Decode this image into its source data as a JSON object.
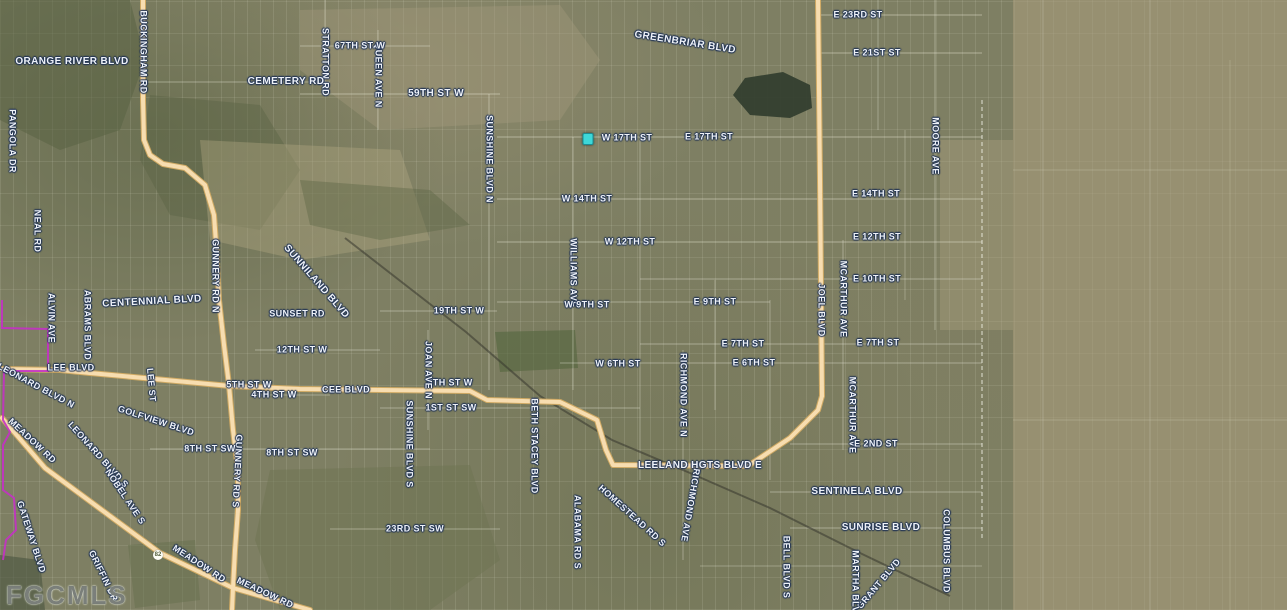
{
  "watermark": "FGCMLS",
  "marker": {
    "x": 588,
    "y": 139,
    "color": "#3ed8d8",
    "border": "#1b8f96"
  },
  "shield": {
    "x": 158,
    "y": 555,
    "label": "82"
  },
  "colors": {
    "base": "#7e7f63",
    "highway_core": "#f7ddb0",
    "highway_casing": "#cfa963",
    "boundary": "#c431c4",
    "railroad": "rgba(55,55,45,0.55)",
    "minor_road": "rgba(238,238,222,0.55)",
    "label_text": "#eef2f8",
    "label_halo": "#223455",
    "water_dark": "#343f2f"
  },
  "labels": [
    {
      "t": "ORANGE RIVER BLVD",
      "x": 72,
      "y": 62,
      "r": 0,
      "s": 10
    },
    {
      "t": "BUCKINGHAM RD",
      "x": 143,
      "y": 52,
      "r": 90,
      "s": 9
    },
    {
      "t": "STRATTON RD",
      "x": 325,
      "y": 62,
      "r": 90,
      "s": 9
    },
    {
      "t": "QUEEN AVE N",
      "x": 378,
      "y": 75,
      "r": 90,
      "s": 9
    },
    {
      "t": "67TH ST W",
      "x": 360,
      "y": 46,
      "r": 0,
      "s": 9
    },
    {
      "t": "CEMETERY RD",
      "x": 286,
      "y": 82,
      "r": 0,
      "s": 10
    },
    {
      "t": "59TH ST W",
      "x": 436,
      "y": 94,
      "r": 0,
      "s": 10
    },
    {
      "t": "GREENBRIAR BLVD",
      "x": 685,
      "y": 43,
      "r": 9,
      "s": 10
    },
    {
      "t": "E 23RD ST",
      "x": 858,
      "y": 15,
      "r": 0,
      "s": 9
    },
    {
      "t": "E 21ST ST",
      "x": 877,
      "y": 53,
      "r": 0,
      "s": 9
    },
    {
      "t": "PANGOLA DR",
      "x": 12,
      "y": 141,
      "r": 90,
      "s": 9
    },
    {
      "t": "NEAL RD",
      "x": 37,
      "y": 231,
      "r": 90,
      "s": 9
    },
    {
      "t": "W 17TH ST",
      "x": 627,
      "y": 138,
      "r": 0,
      "s": 9
    },
    {
      "t": "E 17TH ST",
      "x": 709,
      "y": 137,
      "r": 0,
      "s": 9
    },
    {
      "t": "SUNSHINE BLVD N",
      "x": 489,
      "y": 159,
      "r": 90,
      "s": 9
    },
    {
      "t": "MOORE AVE",
      "x": 935,
      "y": 146,
      "r": 90,
      "s": 9
    },
    {
      "t": "W 14TH ST",
      "x": 587,
      "y": 199,
      "r": 0,
      "s": 9
    },
    {
      "t": "E 14TH ST",
      "x": 876,
      "y": 194,
      "r": 0,
      "s": 9
    },
    {
      "t": "W 12TH ST",
      "x": 630,
      "y": 242,
      "r": 0,
      "s": 9
    },
    {
      "t": "E 12TH ST",
      "x": 877,
      "y": 237,
      "r": 0,
      "s": 9
    },
    {
      "t": "E 10TH ST",
      "x": 877,
      "y": 279,
      "r": 0,
      "s": 9
    },
    {
      "t": "WILLIAMS AVE",
      "x": 573,
      "y": 273,
      "r": 90,
      "s": 9
    },
    {
      "t": "W 9TH ST",
      "x": 587,
      "y": 305,
      "r": 0,
      "s": 9
    },
    {
      "t": "E 9TH ST",
      "x": 715,
      "y": 302,
      "r": 0,
      "s": 9
    },
    {
      "t": "E 7TH ST",
      "x": 743,
      "y": 344,
      "r": 0,
      "s": 9
    },
    {
      "t": "E 7TH ST",
      "x": 878,
      "y": 343,
      "r": 0,
      "s": 9
    },
    {
      "t": "W 6TH ST",
      "x": 618,
      "y": 364,
      "r": 0,
      "s": 9
    },
    {
      "t": "E 6TH ST",
      "x": 754,
      "y": 363,
      "r": 0,
      "s": 9
    },
    {
      "t": "MCARTHUR AVE",
      "x": 843,
      "y": 299,
      "r": 90,
      "s": 9
    },
    {
      "t": "MCARTHUR AVE",
      "x": 852,
      "y": 415,
      "r": 90,
      "s": 9
    },
    {
      "t": "JOEL BLVD",
      "x": 821,
      "y": 310,
      "r": 90,
      "s": 9
    },
    {
      "t": "GUNNERY RD N",
      "x": 215,
      "y": 276,
      "r": 90,
      "s": 9
    },
    {
      "t": "GUNNERY RD S",
      "x": 237,
      "y": 471,
      "r": 93,
      "s": 9
    },
    {
      "t": "CENTENNIAL BLVD",
      "x": 152,
      "y": 302,
      "r": -3,
      "s": 10
    },
    {
      "t": "SUNNILAND BLVD",
      "x": 316,
      "y": 282,
      "r": 49,
      "s": 10
    },
    {
      "t": "SUNSET RD",
      "x": 297,
      "y": 314,
      "r": 0,
      "s": 9
    },
    {
      "t": "19TH ST W",
      "x": 459,
      "y": 311,
      "r": 0,
      "s": 9
    },
    {
      "t": "ALVIN AVE",
      "x": 51,
      "y": 318,
      "r": 90,
      "s": 9
    },
    {
      "t": "ABRAMS BLVD",
      "x": 87,
      "y": 325,
      "r": 90,
      "s": 9
    },
    {
      "t": "12TH ST W",
      "x": 302,
      "y": 350,
      "r": 0,
      "s": 9
    },
    {
      "t": "LEE BLVD",
      "x": 71,
      "y": 368,
      "r": 0,
      "s": 9
    },
    {
      "t": "LEE ST",
      "x": 151,
      "y": 385,
      "r": 85,
      "s": 9
    },
    {
      "t": "LEONARD BLVD N",
      "x": 36,
      "y": 386,
      "r": 28,
      "s": 9
    },
    {
      "t": "5TH ST W",
      "x": 249,
      "y": 385,
      "r": 0,
      "s": 9
    },
    {
      "t": "4TH ST W",
      "x": 274,
      "y": 395,
      "r": 0,
      "s": 9
    },
    {
      "t": "CEE BLVD",
      "x": 346,
      "y": 390,
      "r": 0,
      "s": 9
    },
    {
      "t": "5TH ST W",
      "x": 450,
      "y": 383,
      "r": 0,
      "s": 9
    },
    {
      "t": "1ST ST SW",
      "x": 451,
      "y": 408,
      "r": 0,
      "s": 9
    },
    {
      "t": "JOAN AVE N",
      "x": 428,
      "y": 370,
      "r": 90,
      "s": 9
    },
    {
      "t": "RICHMOND AVE N",
      "x": 683,
      "y": 395,
      "r": 90,
      "s": 9
    },
    {
      "t": "RICHMOND AVE",
      "x": 690,
      "y": 505,
      "r": 100,
      "s": 9
    },
    {
      "t": "GOLFVIEW BLVD",
      "x": 156,
      "y": 421,
      "r": 18,
      "s": 9
    },
    {
      "t": "MEADOW RD",
      "x": 32,
      "y": 441,
      "r": 43,
      "s": 9
    },
    {
      "t": "LEONARD BLVD S",
      "x": 98,
      "y": 455,
      "r": 48,
      "s": 9
    },
    {
      "t": "8TH ST SW",
      "x": 210,
      "y": 449,
      "r": 0,
      "s": 9
    },
    {
      "t": "8TH ST SW",
      "x": 292,
      "y": 453,
      "r": 0,
      "s": 9
    },
    {
      "t": "SUNSHINE BLVD S",
      "x": 409,
      "y": 444,
      "r": 90,
      "s": 9
    },
    {
      "t": "BETH STACEY BLVD",
      "x": 534,
      "y": 446,
      "r": 90,
      "s": 9
    },
    {
      "t": "LEELAND HGTS BLVD E",
      "x": 700,
      "y": 466,
      "r": 0,
      "s": 10
    },
    {
      "t": "E 2ND ST",
      "x": 876,
      "y": 444,
      "r": 0,
      "s": 9
    },
    {
      "t": "NOBEL AVE S",
      "x": 125,
      "y": 497,
      "r": 56,
      "s": 9
    },
    {
      "t": "GATEWAY BLVD",
      "x": 31,
      "y": 537,
      "r": 72,
      "s": 9
    },
    {
      "t": "GRIFFIN DR",
      "x": 103,
      "y": 576,
      "r": 64,
      "s": 9
    },
    {
      "t": "SENTINELA BLVD",
      "x": 857,
      "y": 492,
      "r": 0,
      "s": 10
    },
    {
      "t": "SUNRISE BLVD",
      "x": 881,
      "y": 528,
      "r": 0,
      "s": 10
    },
    {
      "t": "23RD ST SW",
      "x": 415,
      "y": 529,
      "r": 0,
      "s": 9
    },
    {
      "t": "ALABAMA RD S",
      "x": 577,
      "y": 532,
      "r": 90,
      "s": 9
    },
    {
      "t": "HOMESTEAD RD S",
      "x": 632,
      "y": 516,
      "r": 42,
      "s": 9
    },
    {
      "t": "BELL BLVD S",
      "x": 786,
      "y": 567,
      "r": 90,
      "s": 9
    },
    {
      "t": "COLUMBUS BLVD",
      "x": 946,
      "y": 551,
      "r": 90,
      "s": 9
    },
    {
      "t": "GRANT BLVD",
      "x": 879,
      "y": 584,
      "r": -50,
      "s": 9
    },
    {
      "t": "MARTHA BLVD",
      "x": 855,
      "y": 585,
      "r": 90,
      "s": 9
    },
    {
      "t": "MEADOW RD",
      "x": 199,
      "y": 564,
      "r": 33,
      "s": 9
    },
    {
      "t": "MEADOW RD",
      "x": 265,
      "y": 593,
      "r": 25,
      "s": 9
    }
  ],
  "highways": [
    {
      "name": "buckingham-gunnery-rd",
      "pts": [
        [
          143,
          0
        ],
        [
          143,
          100
        ],
        [
          144,
          140
        ],
        [
          150,
          155
        ],
        [
          163,
          164
        ],
        [
          185,
          168
        ],
        [
          205,
          185
        ],
        [
          214,
          215
        ],
        [
          216,
          243
        ],
        [
          219,
          300
        ],
        [
          224,
          345
        ],
        [
          229,
          385
        ],
        [
          233,
          430
        ],
        [
          238,
          470
        ],
        [
          238,
          510
        ],
        [
          235,
          550
        ],
        [
          233,
          588
        ],
        [
          232,
          610
        ]
      ]
    },
    {
      "name": "lee-blvd-cee-blvd-leeland-hgts",
      "pts": [
        [
          0,
          369
        ],
        [
          60,
          370
        ],
        [
          90,
          373
        ],
        [
          230,
          386
        ],
        [
          300,
          389
        ],
        [
          470,
          391
        ],
        [
          487,
          400
        ],
        [
          560,
          402
        ],
        [
          597,
          420
        ],
        [
          606,
          450
        ],
        [
          613,
          465
        ],
        [
          748,
          466
        ],
        [
          790,
          438
        ],
        [
          818,
          410
        ],
        [
          822,
          396
        ]
      ]
    },
    {
      "name": "joel-blvd",
      "pts": [
        [
          818,
          0
        ],
        [
          820,
          180
        ],
        [
          822,
          396
        ]
      ]
    },
    {
      "name": "meadow-rd",
      "pts": [
        [
          2,
          418
        ],
        [
          45,
          468
        ],
        [
          160,
          553
        ],
        [
          233,
          588
        ],
        [
          310,
          610
        ]
      ]
    }
  ],
  "railroad": {
    "pts": [
      [
        345,
        238
      ],
      [
        466,
        332
      ],
      [
        540,
        396
      ],
      [
        612,
        440
      ],
      [
        690,
        473
      ],
      [
        770,
        508
      ],
      [
        860,
        553
      ],
      [
        950,
        596
      ]
    ]
  },
  "boundary": {
    "pts": [
      [
        2,
        300
      ],
      [
        2,
        328
      ],
      [
        48,
        329
      ],
      [
        48,
        371
      ],
      [
        4,
        371
      ],
      [
        3,
        420
      ],
      [
        10,
        432
      ],
      [
        3,
        445
      ],
      [
        3,
        490
      ],
      [
        14,
        498
      ],
      [
        16,
        530
      ],
      [
        6,
        540
      ],
      [
        3,
        560
      ]
    ]
  },
  "terrain": [
    {
      "fill": "#5a6344",
      "op": 0.55,
      "pts": [
        [
          0,
          0
        ],
        [
          130,
          0
        ],
        [
          145,
          60
        ],
        [
          120,
          130
        ],
        [
          60,
          150
        ],
        [
          0,
          120
        ]
      ]
    },
    {
      "fill": "#5a6344",
      "op": 0.45,
      "pts": [
        [
          150,
          95
        ],
        [
          260,
          105
        ],
        [
          300,
          170
        ],
        [
          260,
          230
        ],
        [
          170,
          215
        ],
        [
          140,
          160
        ]
      ]
    },
    {
      "fill": "#b2a783",
      "op": 0.4,
      "pts": [
        [
          200,
          140
        ],
        [
          400,
          150
        ],
        [
          430,
          240
        ],
        [
          300,
          260
        ],
        [
          210,
          240
        ]
      ]
    },
    {
      "fill": "#5a6344",
      "op": 0.4,
      "pts": [
        [
          300,
          180
        ],
        [
          430,
          190
        ],
        [
          470,
          225
        ],
        [
          380,
          240
        ],
        [
          310,
          225
        ]
      ]
    },
    {
      "fill": "#a99f80",
      "op": 0.35,
      "pts": [
        [
          300,
          10
        ],
        [
          560,
          5
        ],
        [
          600,
          60
        ],
        [
          560,
          120
        ],
        [
          380,
          130
        ],
        [
          300,
          70
        ]
      ]
    },
    {
      "fill": "#b2a783",
      "op": 0.35,
      "pts": [
        [
          940,
          140
        ],
        [
          1013,
          140
        ],
        [
          1013,
          330
        ],
        [
          940,
          330
        ]
      ]
    },
    {
      "fill": "#ab9f7d",
      "op": 0.55,
      "pts": [
        [
          1013,
          0
        ],
        [
          1287,
          0
        ],
        [
          1287,
          610
        ],
        [
          1013,
          610
        ]
      ]
    },
    {
      "fill": "#53653e",
      "op": 0.6,
      "pts": [
        [
          495,
          332
        ],
        [
          575,
          330
        ],
        [
          578,
          368
        ],
        [
          500,
          372
        ]
      ]
    },
    {
      "fill": "#6d7352",
      "op": 0.5,
      "pts": [
        [
          270,
          470
        ],
        [
          470,
          465
        ],
        [
          500,
          560
        ],
        [
          430,
          610
        ],
        [
          280,
          610
        ],
        [
          255,
          540
        ]
      ]
    },
    {
      "fill": "#66704e",
      "op": 0.5,
      "pts": [
        [
          128,
          545
        ],
        [
          195,
          540
        ],
        [
          200,
          600
        ],
        [
          135,
          608
        ]
      ]
    },
    {
      "fill": "#4a5440",
      "op": 0.6,
      "pts": [
        [
          0,
          555
        ],
        [
          40,
          560
        ],
        [
          45,
          610
        ],
        [
          0,
          610
        ]
      ]
    },
    {
      "fill": "#343f2f",
      "op": 0.95,
      "pts": [
        [
          733,
          95
        ],
        [
          745,
          78
        ],
        [
          783,
          72
        ],
        [
          810,
          85
        ],
        [
          812,
          108
        ],
        [
          790,
          118
        ],
        [
          750,
          115
        ]
      ]
    }
  ],
  "minor_roads": [
    [
      820,
      15,
      982,
      15,
      0.55
    ],
    [
      820,
      53,
      982,
      53,
      0.55
    ],
    [
      300,
      46,
      430,
      46,
      0.5
    ],
    [
      140,
      82,
      330,
      82,
      0.5
    ],
    [
      300,
      94,
      500,
      94,
      0.55
    ],
    [
      497,
      137,
      982,
      137,
      0.55
    ],
    [
      497,
      199,
      982,
      199,
      0.55
    ],
    [
      497,
      242,
      982,
      242,
      0.55
    ],
    [
      640,
      279,
      982,
      279,
      0.5
    ],
    [
      497,
      302,
      770,
      302,
      0.5
    ],
    [
      380,
      311,
      497,
      311,
      0.5
    ],
    [
      640,
      344,
      982,
      344,
      0.5
    ],
    [
      560,
      363,
      982,
      363,
      0.5
    ],
    [
      255,
      350,
      380,
      350,
      0.5
    ],
    [
      255,
      395,
      330,
      395,
      0.45
    ],
    [
      380,
      408,
      640,
      408,
      0.5
    ],
    [
      150,
      449,
      430,
      449,
      0.5
    ],
    [
      790,
      444,
      982,
      444,
      0.5
    ],
    [
      770,
      492,
      982,
      492,
      0.5
    ],
    [
      790,
      528,
      982,
      528,
      0.5
    ],
    [
      330,
      529,
      500,
      529,
      0.5
    ],
    [
      700,
      566,
      982,
      566,
      0.4
    ],
    [
      325,
      0,
      325,
      94,
      0.5
    ],
    [
      378,
      30,
      378,
      130,
      0.5
    ],
    [
      428,
      330,
      428,
      430,
      0.5
    ],
    [
      489,
      94,
      489,
      390,
      0.55
    ],
    [
      573,
      137,
      573,
      390,
      0.5
    ],
    [
      640,
      137,
      640,
      480,
      0.45
    ],
    [
      683,
      350,
      683,
      560,
      0.5
    ],
    [
      715,
      280,
      715,
      410,
      0.45
    ],
    [
      770,
      300,
      770,
      480,
      0.45
    ],
    [
      843,
      240,
      843,
      450,
      0.5
    ],
    [
      878,
      0,
      878,
      130,
      0.45
    ],
    [
      905,
      130,
      905,
      300,
      0.4
    ],
    [
      935,
      0,
      935,
      330,
      0.5
    ],
    [
      1043,
      0,
      1043,
      610,
      0.3
    ],
    [
      1150,
      0,
      1150,
      610,
      0.3
    ],
    [
      1230,
      60,
      1230,
      610,
      0.25
    ],
    [
      1013,
      170,
      1287,
      170,
      0.25
    ],
    [
      1013,
      420,
      1287,
      420,
      0.25
    ]
  ],
  "survey_line": {
    "x": 982,
    "y1": 100,
    "y2": 540
  }
}
